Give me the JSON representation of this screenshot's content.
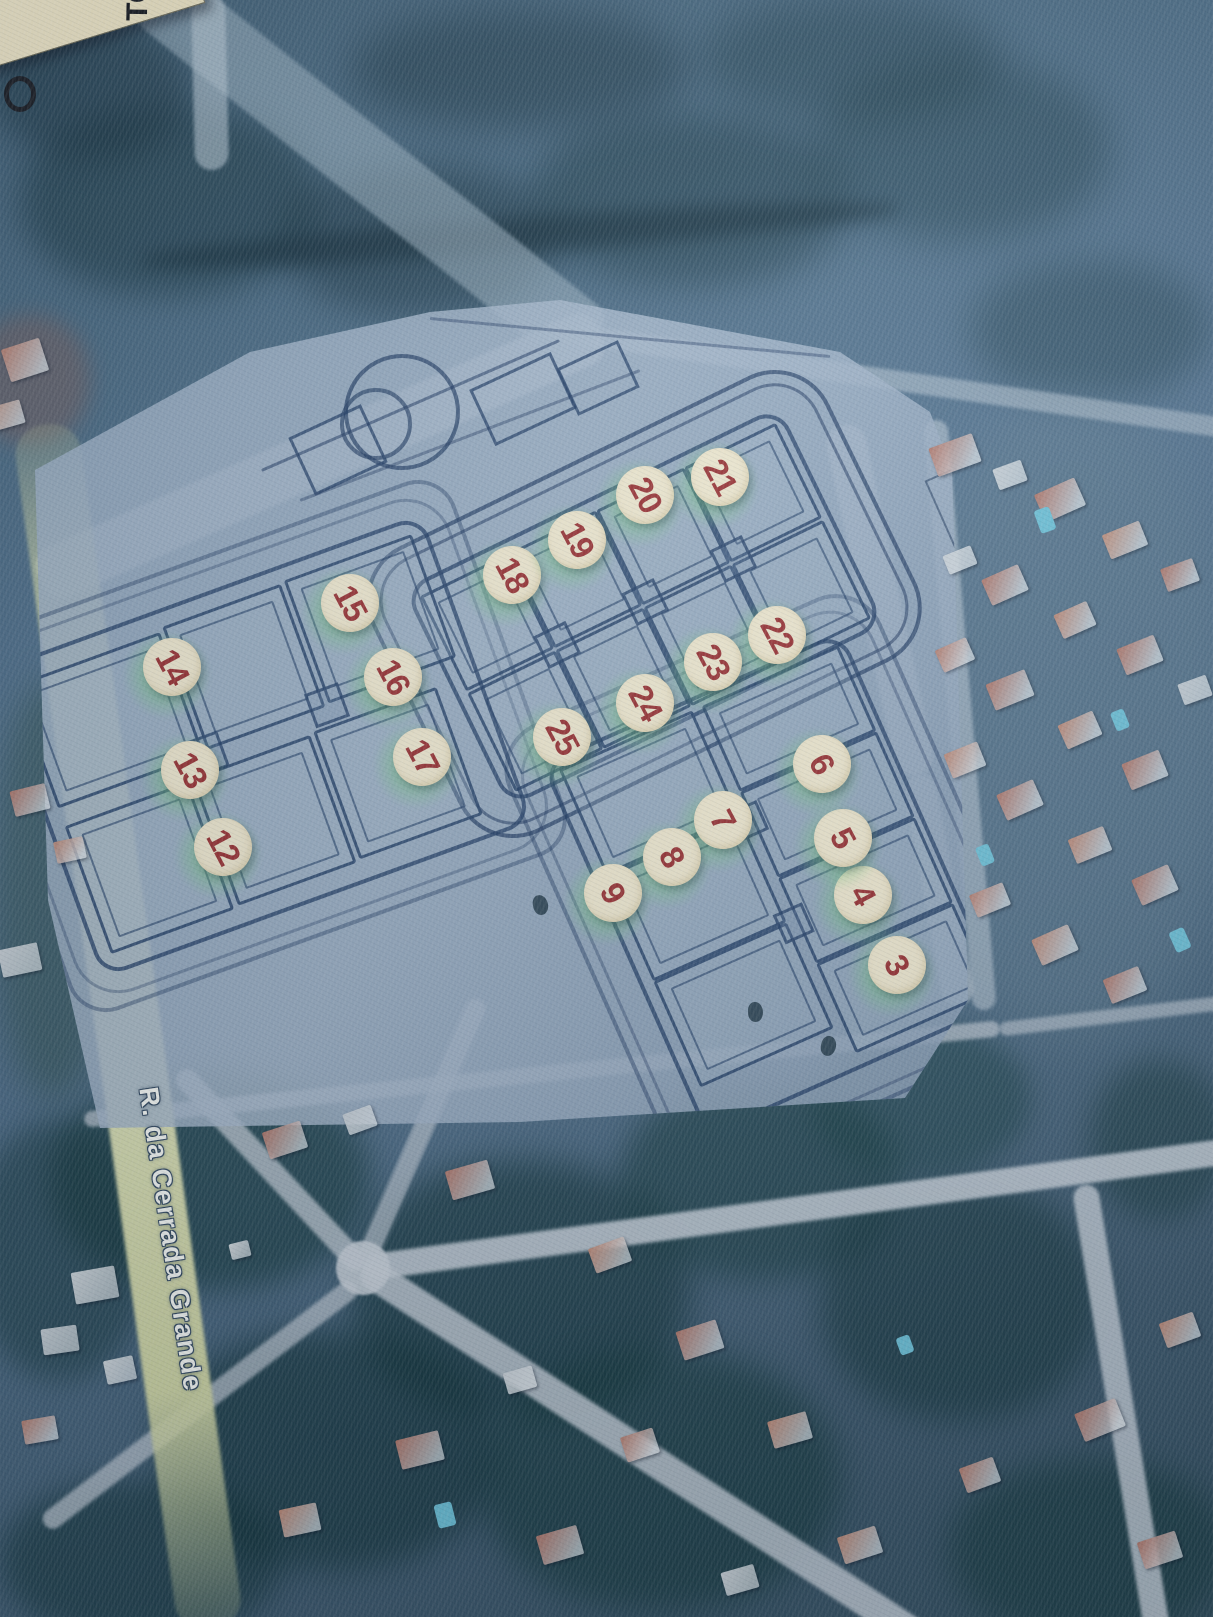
{
  "photo_map": {
    "corner_note": {
      "text": "TO"
    },
    "street_label": {
      "text": "R. da Cerrada Grande"
    },
    "lot_markers": [
      {
        "number": "3",
        "x": 897,
        "y": 965
      },
      {
        "number": "4",
        "x": 863,
        "y": 895
      },
      {
        "number": "5",
        "x": 843,
        "y": 838
      },
      {
        "number": "6",
        "x": 822,
        "y": 764
      },
      {
        "number": "7",
        "x": 723,
        "y": 820
      },
      {
        "number": "8",
        "x": 672,
        "y": 857
      },
      {
        "number": "9",
        "x": 613,
        "y": 893
      },
      {
        "number": "12",
        "x": 223,
        "y": 847
      },
      {
        "number": "13",
        "x": 190,
        "y": 770
      },
      {
        "number": "14",
        "x": 172,
        "y": 667
      },
      {
        "number": "15",
        "x": 350,
        "y": 603
      },
      {
        "number": "16",
        "x": 393,
        "y": 677
      },
      {
        "number": "17",
        "x": 422,
        "y": 757
      },
      {
        "number": "18",
        "x": 512,
        "y": 575
      },
      {
        "number": "19",
        "x": 577,
        "y": 540
      },
      {
        "number": "20",
        "x": 645,
        "y": 495
      },
      {
        "number": "21",
        "x": 720,
        "y": 477
      },
      {
        "number": "22",
        "x": 777,
        "y": 635
      },
      {
        "number": "23",
        "x": 713,
        "y": 662
      },
      {
        "number": "24",
        "x": 645,
        "y": 703
      },
      {
        "number": "25",
        "x": 562,
        "y": 737
      }
    ],
    "colors": {
      "marker_fill": "#f3ebd1",
      "marker_text": "#9c3233",
      "marker_glow": "#76cc80",
      "plan_line": "#213d65",
      "plan_paper": "#9badc2",
      "road_yellow": "#d8ddad",
      "road_light": "#c6cfd8",
      "satellite_dark": "#16333e",
      "roof_salmon": "#b3786a",
      "pool_cyan": "#6fc3d9"
    }
  }
}
